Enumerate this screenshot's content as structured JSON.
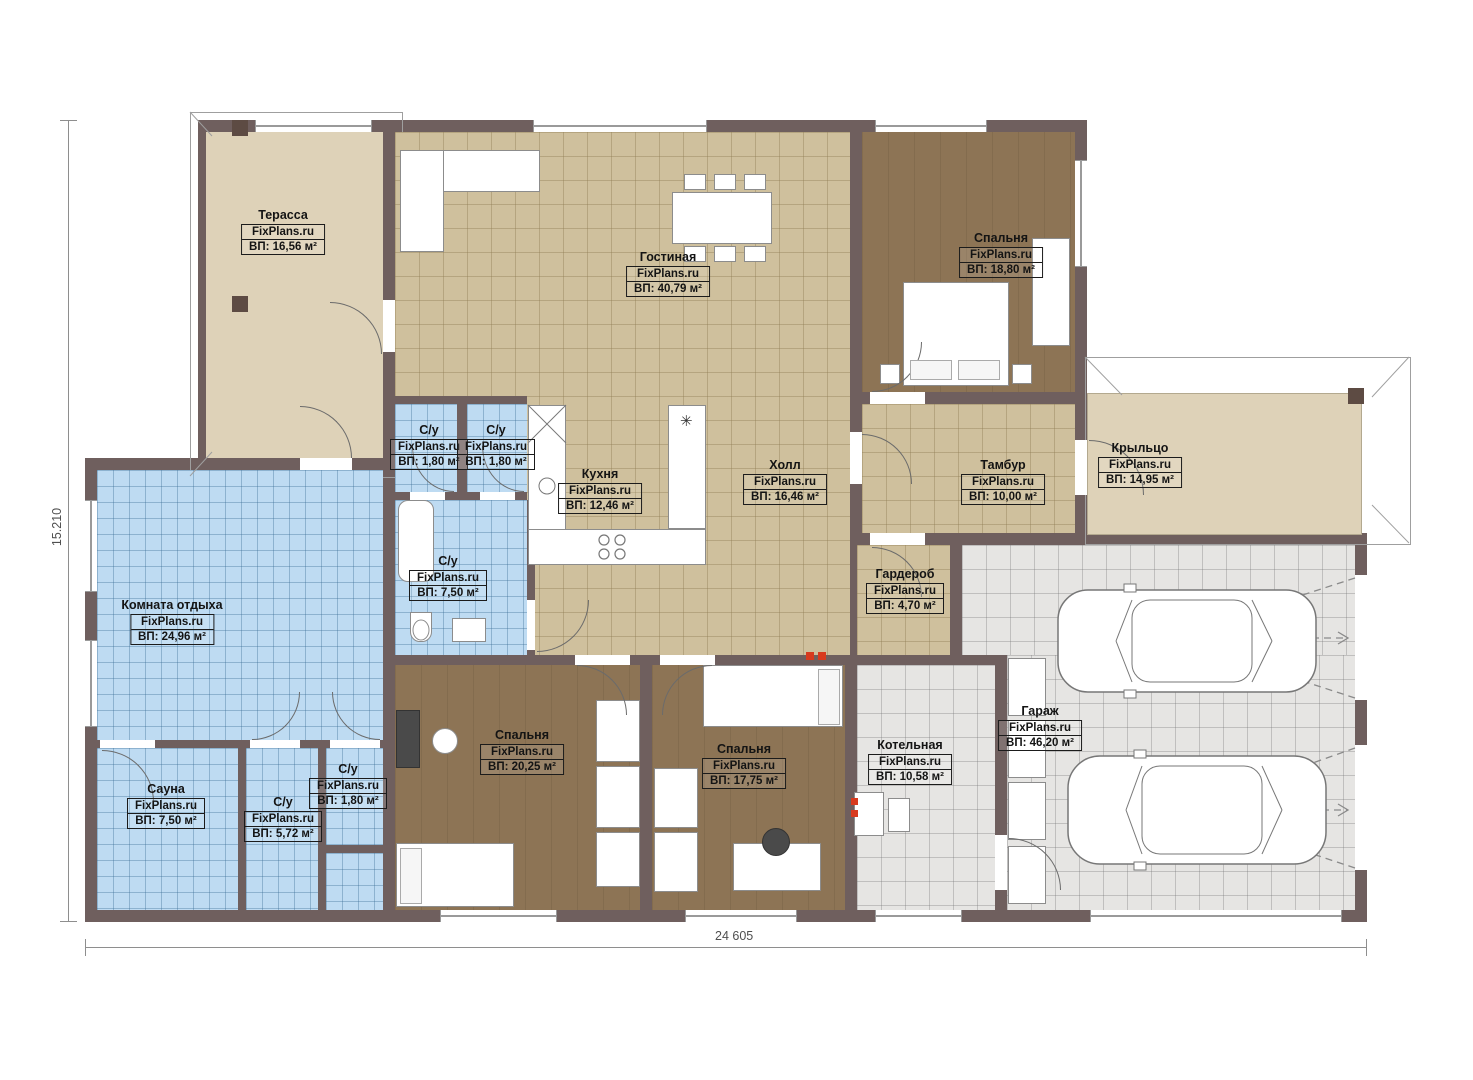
{
  "watermark": "FixPlans.ru",
  "dimensions": {
    "bottom": "24 605",
    "left": "15.210"
  },
  "icons": {
    "vent": "✳"
  },
  "colors": {
    "wall": "#6f5f5e",
    "tile_tan": "#cfc09d",
    "tile_blue": "#bedbf2",
    "tile_gray": "#e6e5e3",
    "floor_beige": "#ded2b8",
    "floor_brown": "#8d7455",
    "marker_red": "#d83a1e"
  },
  "rooms": [
    {
      "name": "Терасса",
      "area": "ВП: 16,56 м²"
    },
    {
      "name": "Гостиная",
      "area": "ВП: 40,79 м²"
    },
    {
      "name": "Спальня",
      "area": "ВП: 18,80 м²"
    },
    {
      "name": "С/у",
      "area": "ВП: 1,80 м²"
    },
    {
      "name": "С/у",
      "area": "ВП: 1,80 м²"
    },
    {
      "name": "Кухня",
      "area": "ВП: 12,46 м²"
    },
    {
      "name": "Холл",
      "area": "ВП: 16,46 м²"
    },
    {
      "name": "Тамбур",
      "area": "ВП: 10,00 м²"
    },
    {
      "name": "Крыльцо",
      "area": "ВП: 14,95 м²"
    },
    {
      "name": "Гардероб",
      "area": "ВП: 4,70 м²"
    },
    {
      "name": "Комната отдыха",
      "area": "ВП: 24,96 м²"
    },
    {
      "name": "С/у",
      "area": "ВП: 7,50 м²"
    },
    {
      "name": "Сауна",
      "area": "ВП: 7,50 м²"
    },
    {
      "name": "С/у",
      "area": "ВП: 5,72 м²"
    },
    {
      "name": "С/у",
      "area": "ВП: 1,80 м²"
    },
    {
      "name": "Спальня",
      "area": "ВП: 20,25 м²"
    },
    {
      "name": "Спальня",
      "area": "ВП: 17,75 м²"
    },
    {
      "name": "Котельная",
      "area": "ВП: 10,58 м²"
    },
    {
      "name": "Гараж",
      "area": "ВП: 46,20 м²"
    }
  ]
}
